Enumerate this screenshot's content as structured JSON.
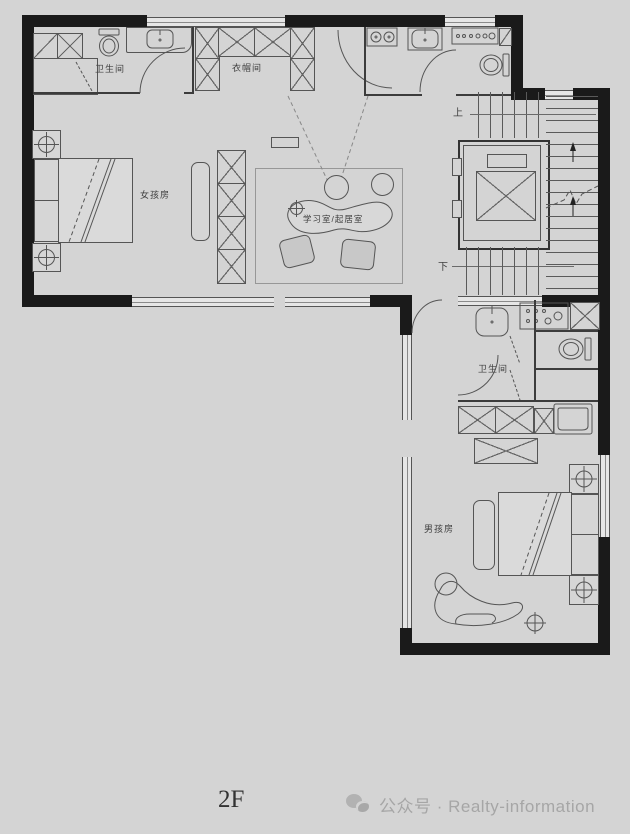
{
  "meta": {
    "type": "floor-plan",
    "floor": "2F"
  },
  "rooms": {
    "bathroom_top_left": {
      "label": "卫生间"
    },
    "walk_in_closet": {
      "label": "衣帽间"
    },
    "girls_room": {
      "label": "女孩房"
    },
    "study_living": {
      "label": "学习室/起居室"
    },
    "bathroom_right": {
      "label": "卫生间"
    },
    "boys_room": {
      "label": "男孩房"
    }
  },
  "stairs": {
    "up": "上",
    "down": "下"
  },
  "footer": {
    "floor_label": "2F",
    "credit": "公众号 · Realty-information",
    "icon": "wechat-icon"
  },
  "colors": {
    "background": "#d4d4d4",
    "wall": "#1a1a1a",
    "line": "#555555",
    "footer_text": "#a6a6a6",
    "floor_text": "#333333"
  }
}
